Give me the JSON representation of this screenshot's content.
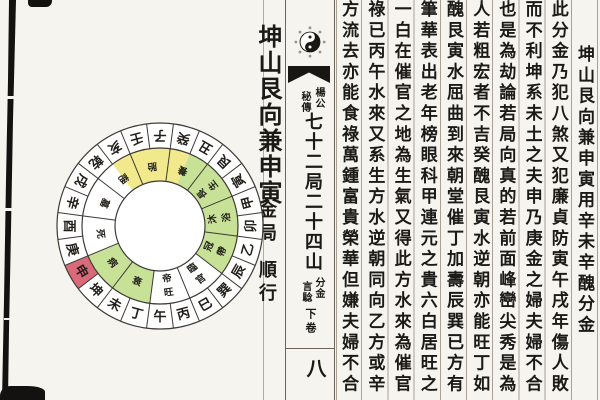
{
  "page": {
    "right_page": {
      "columns": [
        "坤山艮向兼申寅用辛未辛醜分金",
        "此分金乃犯八煞又犯廉貞防寅午戌年傷人敗",
        "而不利坤系未土之夫申乃庚金之婦夫婦不合",
        "也是為劫論若局向真的若前面峰巒尖秀是為",
        "人若粗宏者不吉癸醜艮寅水逆朝亦能旺丁如",
        "醜艮寅水屈曲到來朝堂催丁加壽辰巽已方有",
        "筆華表出老年榜眼科甲連元之貴六白居旺之",
        "一白在催官之地為生氣又得此方水來為催官",
        "祿已丙午水來又系生方水逆朝同向乙方或辛",
        "方流去亦能食祿萬鍾富貴榮華但嫌夫婦不合"
      ]
    },
    "spine": {
      "attribution_right": "楊公",
      "attribution_left": "秘傳",
      "title": "七十二局二十四山",
      "subtitle_right": "分金",
      "subtitle_left": "言騐",
      "volume": "下卷",
      "page_number": "八",
      "taiji_icon": "yin-yang"
    },
    "left_page": {
      "title": "坤山艮向兼申寅",
      "cycle": "金局",
      "direction": "順行",
      "compass": {
        "mountains": [
          "子",
          "癸",
          "丑",
          "艮",
          "寅",
          "甲",
          "卯",
          "乙",
          "辰",
          "巽",
          "巳",
          "丙",
          "午",
          "丁",
          "未",
          "坤",
          "申",
          "庚",
          "酉",
          "辛",
          "戌",
          "乾",
          "亥",
          "壬"
        ],
        "highlight_mountain": "申",
        "highlight_color": "#d96a79",
        "color_regions": [
          {
            "mountains": "亥壬子癸",
            "color": "#f2e98c"
          },
          {
            "mountains": "丑艮寅甲卯乙辰",
            "color": "#c7e197"
          },
          {
            "mountains": "丁未坤申",
            "color": "#c7e197"
          }
        ],
        "sectors": [
          {
            "mountains": "壬子",
            "label": "胎"
          },
          {
            "mountains": "癸丑",
            "label": "養"
          },
          {
            "mountains": "艮寅",
            "label": "長生"
          },
          {
            "mountains": "甲卯",
            "label": "沐浴"
          },
          {
            "mountains": "乙辰",
            "label": "冠帶"
          },
          {
            "mountains": "巽巳",
            "label": "臨官"
          },
          {
            "mountains": "丙午",
            "label": "帝旺"
          },
          {
            "mountains": "丁未",
            "label": "衰"
          },
          {
            "mountains": "坤申",
            "label": "病"
          },
          {
            "mountains": "庚酉",
            "label": "死"
          },
          {
            "mountains": "辛戌",
            "label": "墓"
          },
          {
            "mountains": "乾亥",
            "label": "絕"
          }
        ],
        "line_color": "#3c3a36",
        "text_color": "#23201c"
      }
    }
  }
}
